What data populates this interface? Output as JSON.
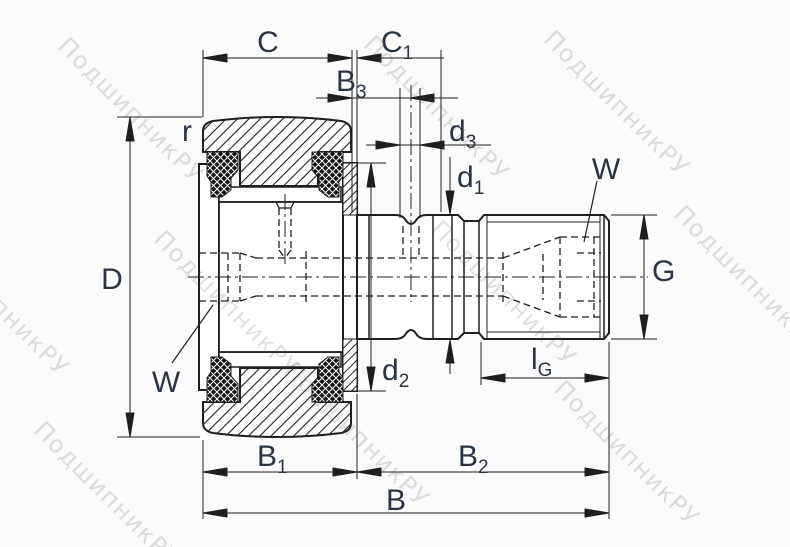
{
  "watermark": {
    "text": "ПодшипникРУ"
  },
  "dims": {
    "C": {
      "base": "C",
      "sub": ""
    },
    "C1": {
      "base": "C",
      "sub": "1"
    },
    "B3": {
      "base": "B",
      "sub": "3"
    },
    "d3": {
      "base": "d",
      "sub": "3"
    },
    "d1": {
      "base": "d",
      "sub": "1"
    },
    "d2": {
      "base": "d",
      "sub": "2"
    },
    "D": {
      "base": "D",
      "sub": ""
    },
    "r": {
      "base": "r",
      "sub": ""
    },
    "W_left": {
      "base": "W",
      "sub": ""
    },
    "W_right": {
      "base": "W",
      "sub": ""
    },
    "G": {
      "base": "G",
      "sub": ""
    },
    "lG": {
      "base": "l",
      "sub": "G"
    },
    "B1": {
      "base": "B",
      "sub": "1"
    },
    "B2": {
      "base": "B",
      "sub": "2"
    },
    "B": {
      "base": "B",
      "sub": ""
    }
  },
  "colors": {
    "ink": "#1f1f1f",
    "label": "#2b3442",
    "watermark_gray": "#b9b9b9",
    "background": "#fbfbfb"
  }
}
